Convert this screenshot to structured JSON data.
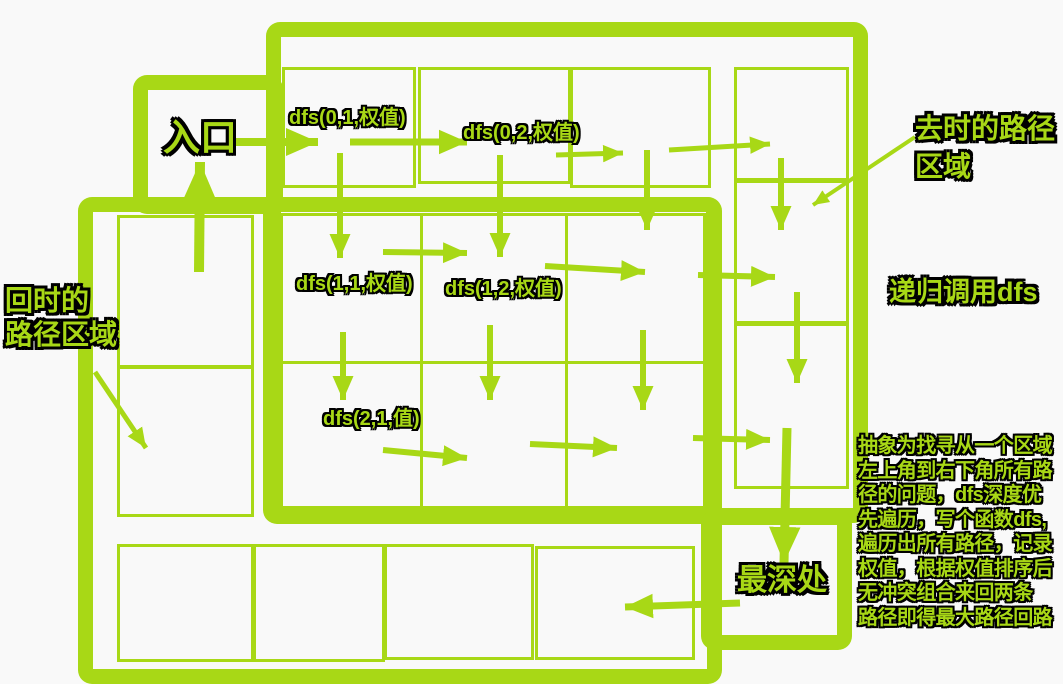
{
  "canvas": {
    "width": 1063,
    "height": 684
  },
  "colors": {
    "green": "#a8d816",
    "background": "#f9f9f9",
    "text_outline": "#000000"
  },
  "labels": {
    "entrance": "入口",
    "outbound_area": [
      "去时的路径",
      "区域"
    ],
    "return_area": [
      "回时的",
      "路径区域"
    ],
    "recursion": "递归调用dfs",
    "deepest": "最深处",
    "calls": {
      "c01": "dfs(0,1,权值)",
      "c02": "dfs(0,2,权值)",
      "c11": "dfs(1,1,权值)",
      "c12": "dfs(1,2,权值)",
      "c21": "dfs(2,1,值)"
    },
    "note_lines": [
      "抽象为找寻从一个区域",
      "左上角到右下角所有路",
      "径的问题，dfs深度优",
      "先遍历，写个函数dfs,",
      "遍历出所有路径，记录",
      "权值，根据权值排序后",
      "无冲突组合来回两条",
      "路径即得最大路径回路"
    ]
  }
}
